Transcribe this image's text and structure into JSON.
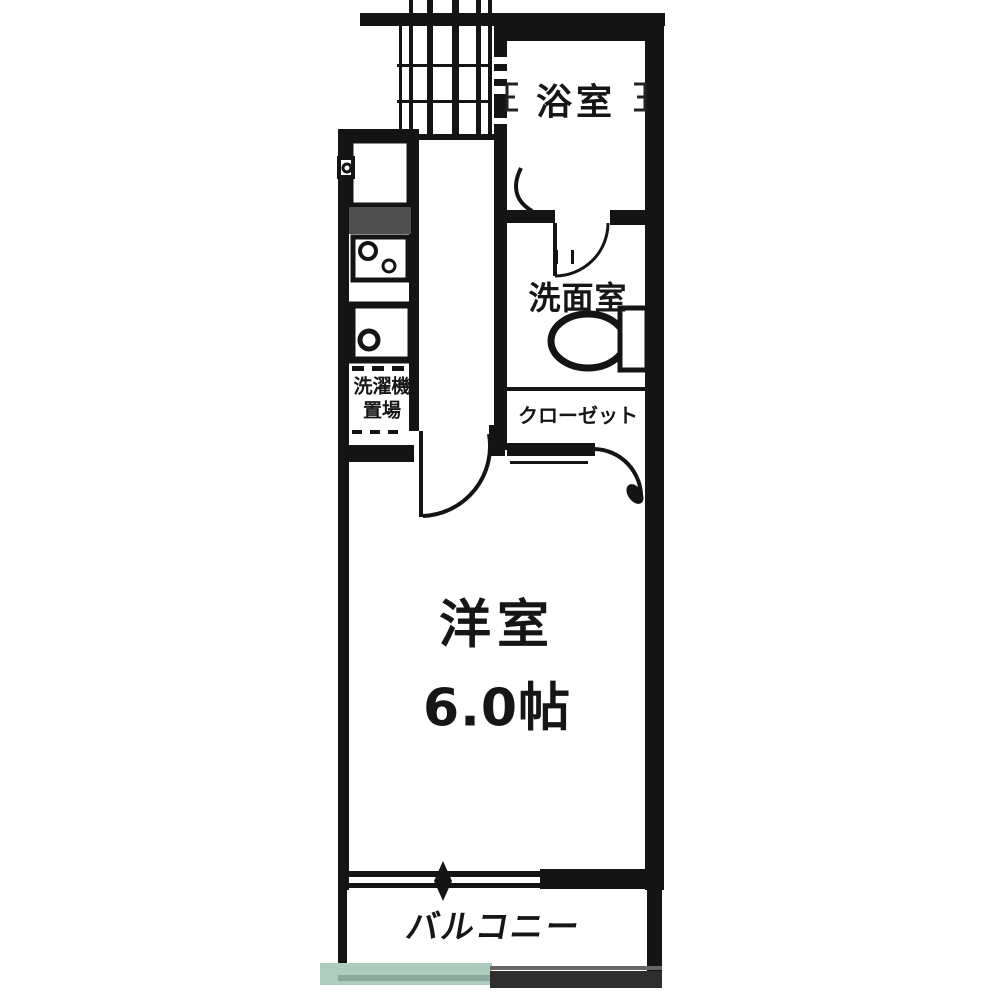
{
  "floor_plan": {
    "rooms": {
      "bath": {
        "label": "浴室"
      },
      "washroom": {
        "label": "洗面室"
      },
      "closet": {
        "label": "クローゼット"
      },
      "laundry": {
        "line1": "洗濯機",
        "line2": "置場"
      },
      "western_room": {
        "name": "洋室",
        "size": "6.0帖"
      },
      "balcony": {
        "label": "バルコニー"
      }
    },
    "colors": {
      "wall": "#141414",
      "text": "#161616",
      "fixture_hatch": "#4f4f4f",
      "balcony_edge_green": "#aecbbd",
      "balcony_edge_dark": "#2e2e2e",
      "background": "#ffffff"
    }
  }
}
